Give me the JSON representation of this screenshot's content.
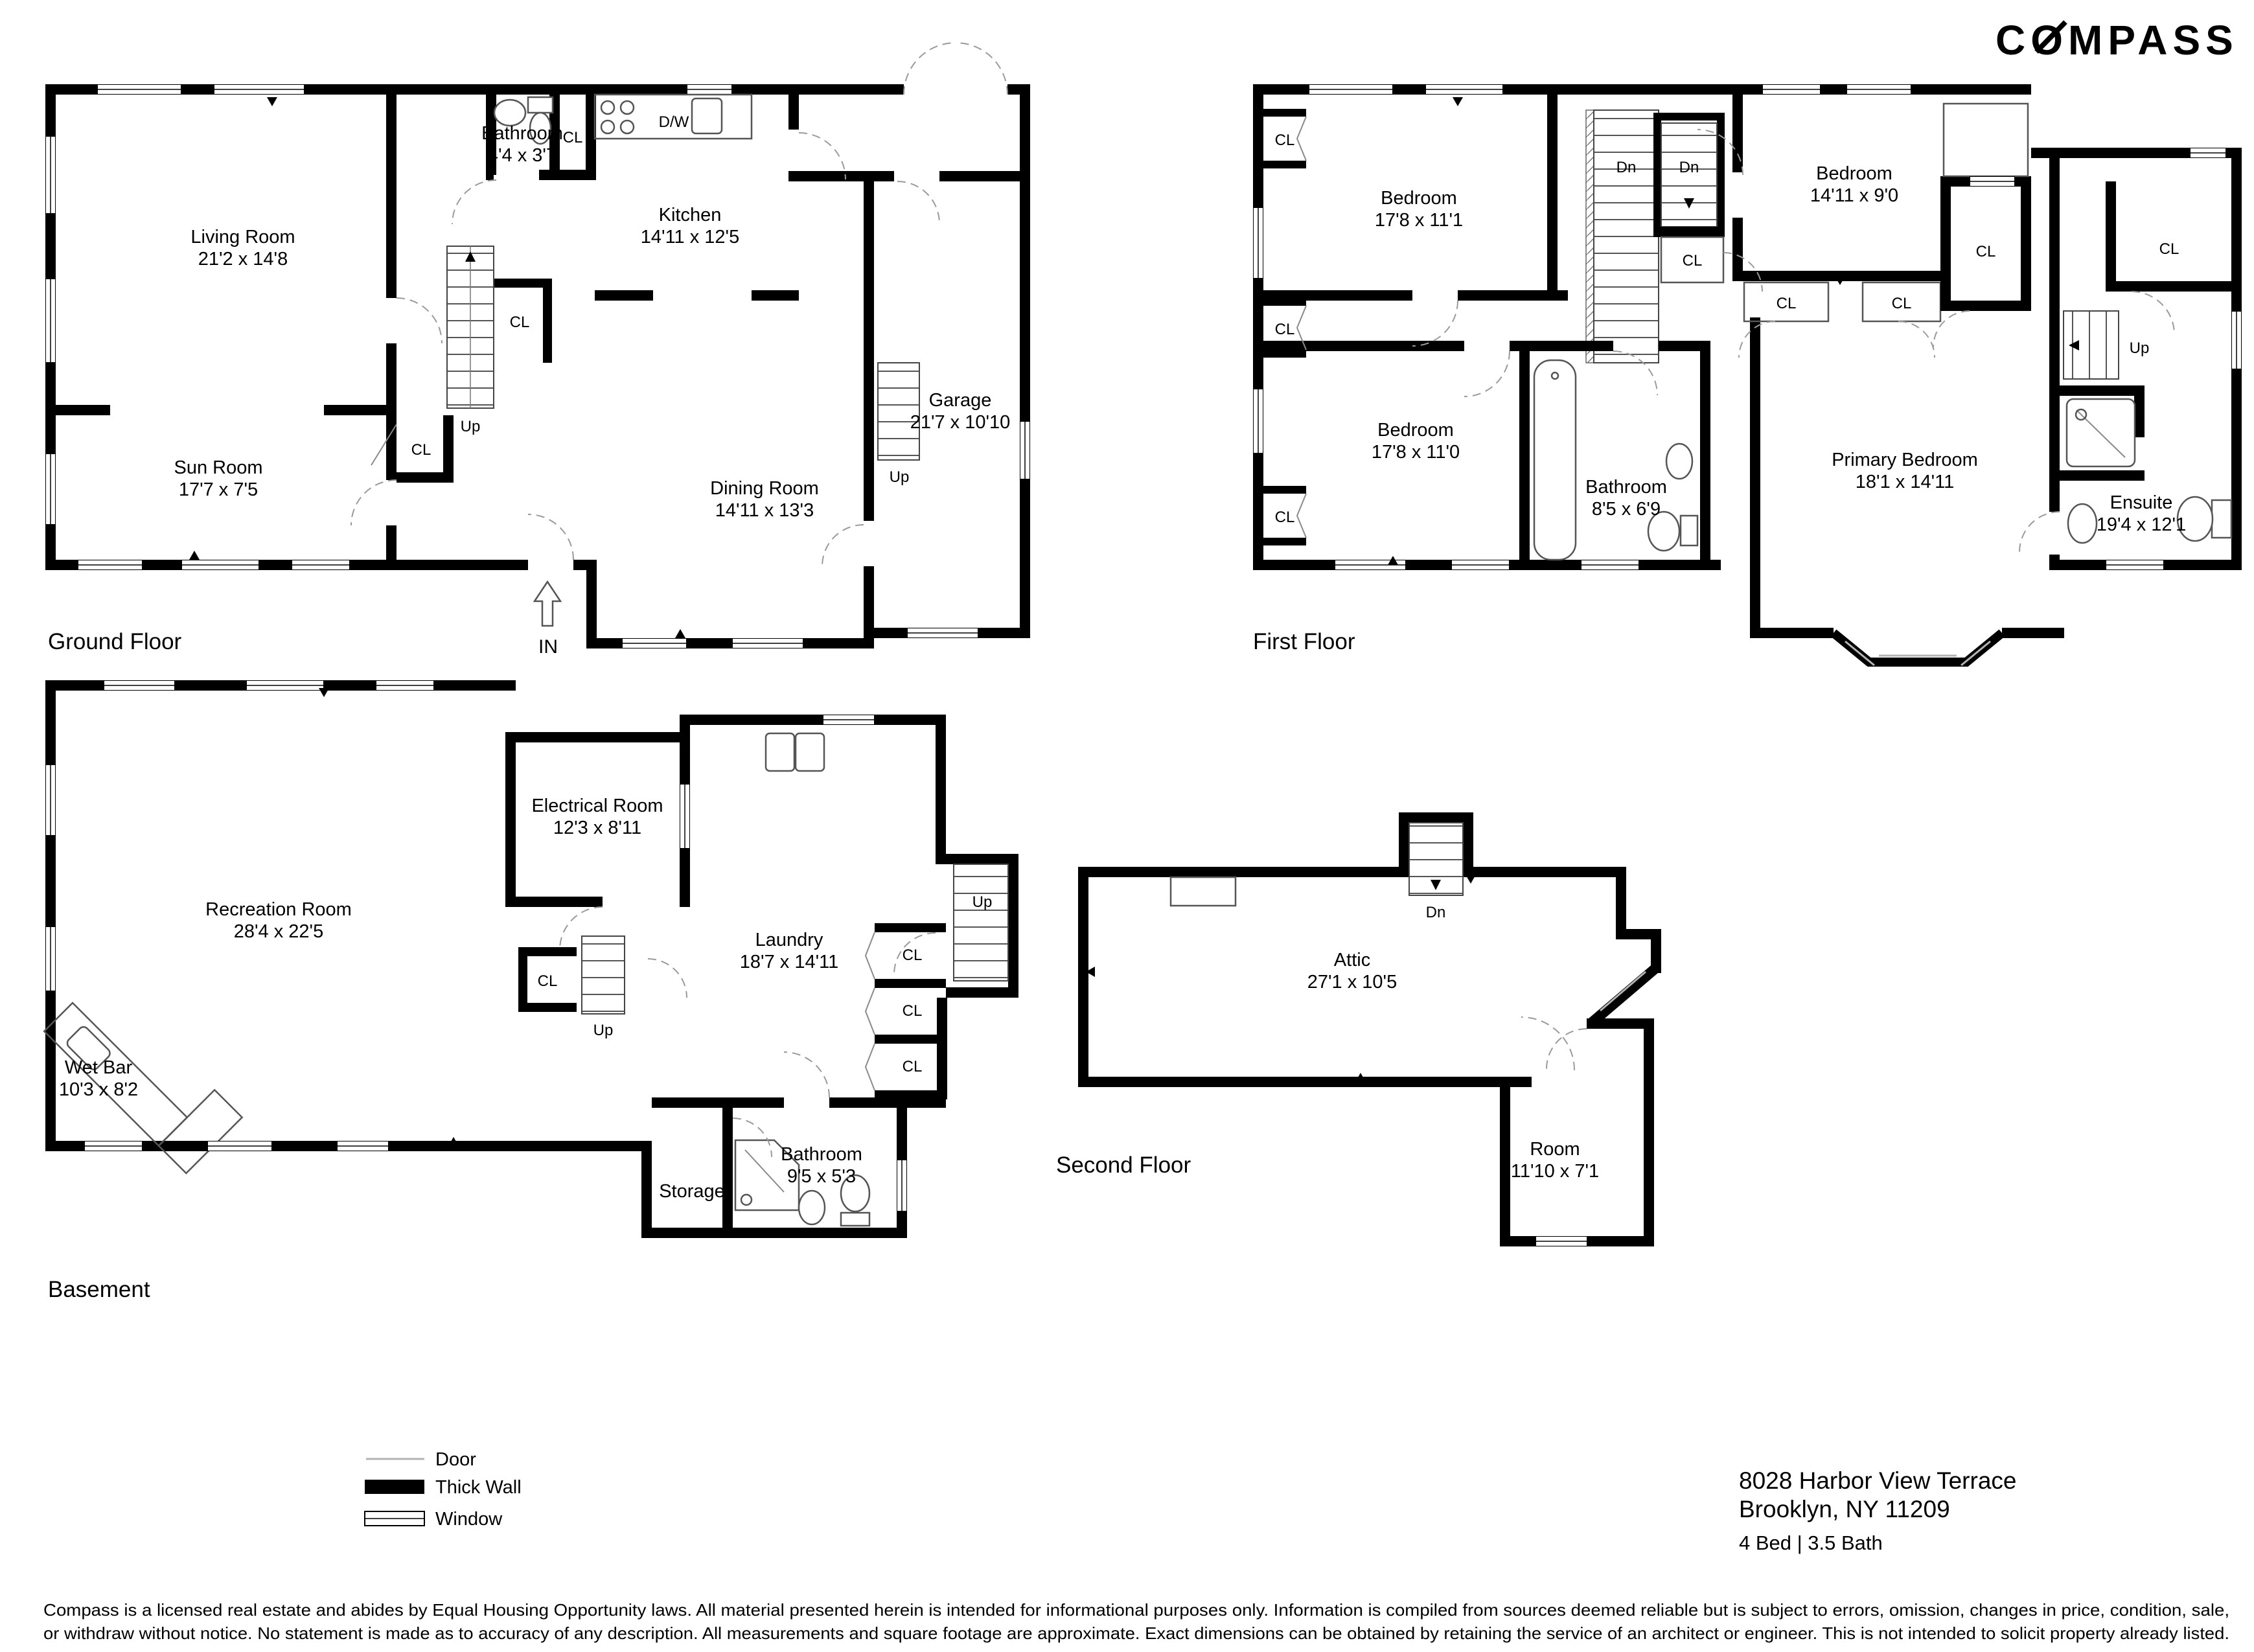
{
  "logo": "COMPASS",
  "markers": {
    "closet": "CL",
    "up": "Up",
    "down": "Dn",
    "in": "IN",
    "dishwasher": "D/W"
  },
  "floors": {
    "ground": {
      "title": "Ground Floor",
      "rooms": {
        "living": {
          "name": "Living Room",
          "dims": "21'2 x 14'8"
        },
        "sun": {
          "name": "Sun Room",
          "dims": "17'7 x 7'5"
        },
        "bath": {
          "name": "Bathroom",
          "dims": "4'4 x 3'7"
        },
        "kitchen": {
          "name": "Kitchen",
          "dims": "14'11 x 12'5"
        },
        "dining": {
          "name": "Dining Room",
          "dims": "14'11 x 13'3"
        },
        "garage": {
          "name": "Garage",
          "dims": "21'7 x 10'10"
        }
      }
    },
    "first": {
      "title": "First Floor",
      "rooms": {
        "bedroom1": {
          "name": "Bedroom",
          "dims": "17'8 x 11'1"
        },
        "bedroom2": {
          "name": "Bedroom",
          "dims": "14'11 x 9'0"
        },
        "bedroom3": {
          "name": "Bedroom",
          "dims": "17'8 x 11'0"
        },
        "bath": {
          "name": "Bathroom",
          "dims": "8'5 x 6'9"
        },
        "primary": {
          "name": "Primary Bedroom",
          "dims": "18'1 x 14'11"
        },
        "ensuite": {
          "name": "Ensuite",
          "dims": "19'4 x 12'1"
        }
      }
    },
    "basement": {
      "title": "Basement",
      "rooms": {
        "rec": {
          "name": "Recreation Room",
          "dims": "28'4 x 22'5"
        },
        "electrical": {
          "name": "Electrical Room",
          "dims": "12'3 x 8'11"
        },
        "wetbar": {
          "name": "Wet Bar",
          "dims": "10'3 x 8'2"
        },
        "laundry": {
          "name": "Laundry",
          "dims": "18'7 x 14'11"
        },
        "storage": {
          "name": "Storage"
        },
        "bath": {
          "name": "Bathroom",
          "dims": "9'5 x 5'3"
        }
      }
    },
    "second": {
      "title": "Second Floor",
      "rooms": {
        "attic": {
          "name": "Attic",
          "dims": "27'1 x 10'5"
        },
        "room": {
          "name": "Room",
          "dims": "11'10 x 7'1"
        }
      }
    }
  },
  "legend": {
    "door": "Door",
    "thick_wall": "Thick Wall",
    "window": "Window"
  },
  "listing": {
    "address_line1": "8028 Harbor View Terrace",
    "address_line2": "Brooklyn, NY 11209",
    "beds_baths": "4 Bed | 3.5 Bath"
  },
  "disclaimer": {
    "line1": "Compass is a licensed real estate and abides by Equal Housing Opportunity laws. All material presented herein is intended for informational purposes only. Information is compiled from sources deemed reliable but is subject to errors, omission, changes in price, condition, sale,",
    "line2": "or withdraw without notice. No statement is made as to accuracy of any description. All measurements and square footage are approximate. Exact dimensions can be obtained by retaining the service of an architect or engineer. This is not intended to solicit property already listed."
  }
}
